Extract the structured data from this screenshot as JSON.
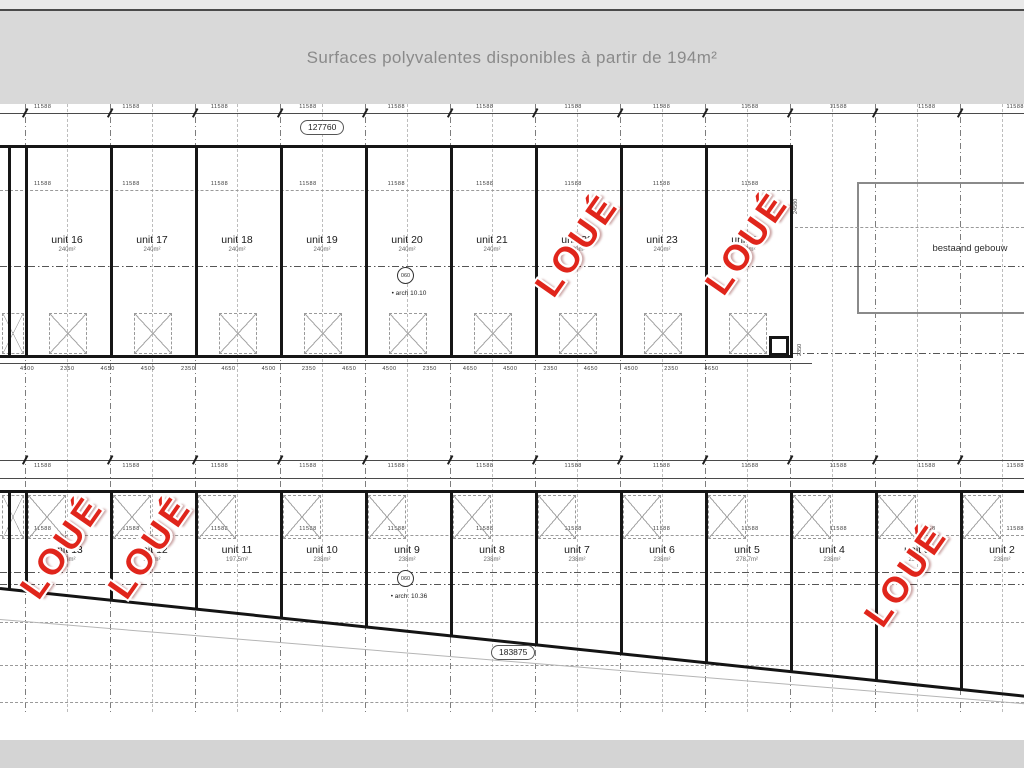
{
  "header": {
    "title": "Surfaces polyvalentes disponibles à partir de 194m²"
  },
  "stamp": {
    "label": "LOUÉ",
    "color": "#e0251b"
  },
  "plan": {
    "dim_top": "127760",
    "dim_bottom": "183875",
    "existing_building_label": "bestaand gebouw",
    "arch_note_top": {
      "circle": "060",
      "text": "• arch 10.10"
    },
    "arch_note_bottom": {
      "circle": "060",
      "text": "• arch: 10.36"
    },
    "side_dim_right": "24580",
    "side_dim_corner": "2350",
    "tiny_dim_rows": {
      "r1": "11588 11588 11588 11588 11588 11588 11588 11588 11588 11588 11588 11588",
      "r2": "11588 11588 11588 11588 11588 11588 11588 11588 11588",
      "r3": "4500 2350 4650 4500 2350 4650 4500 2350 4650 4500 2350 4650 4500 2350 4650 4500 2350 4650",
      "r4": "11588 11588 11588 11588 11588 11588 11588 11588 11588 11588 11588 11588",
      "r5": "11588 11588 11588 11588 11588 11588 11588 11588 11588 11588 11588 11588"
    },
    "top_row": {
      "units": [
        {
          "label": "unit 16",
          "area": "240m²",
          "rented": false
        },
        {
          "label": "unit 17",
          "area": "240m²",
          "rented": false
        },
        {
          "label": "unit 18",
          "area": "240m²",
          "rented": false
        },
        {
          "label": "unit 19",
          "area": "240m²",
          "rented": false
        },
        {
          "label": "unit 20",
          "area": "240m²",
          "rented": false
        },
        {
          "label": "unit 21",
          "area": "240m²",
          "rented": false
        },
        {
          "label": "unit 22",
          "area": "240m²",
          "rented": true
        },
        {
          "label": "unit 23",
          "area": "240m²",
          "rented": false
        },
        {
          "label": "unit 24",
          "area": "240m²",
          "rented": true
        }
      ]
    },
    "bottom_row": {
      "units": [
        {
          "label": "unit 13",
          "area": "238m²",
          "rented": true
        },
        {
          "label": "unit 12",
          "area": "238m²",
          "rented": true
        },
        {
          "label": "unit 11",
          "area": "197.5m²",
          "rented": false
        },
        {
          "label": "unit 10",
          "area": "238m²",
          "rented": false
        },
        {
          "label": "unit 9",
          "area": "238m²",
          "rented": false
        },
        {
          "label": "unit 8",
          "area": "238m²",
          "rented": false
        },
        {
          "label": "unit 7",
          "area": "238m²",
          "rented": false
        },
        {
          "label": "unit 6",
          "area": "238m²",
          "rented": false
        },
        {
          "label": "unit 5",
          "area": "278.7m²",
          "rented": false
        },
        {
          "label": "unit 4",
          "area": "238m²",
          "rented": false
        },
        {
          "label": "unit 3",
          "area": "238m²",
          "rented": true
        },
        {
          "label": "unit 2",
          "area": "238m²",
          "rented": false
        }
      ]
    }
  }
}
